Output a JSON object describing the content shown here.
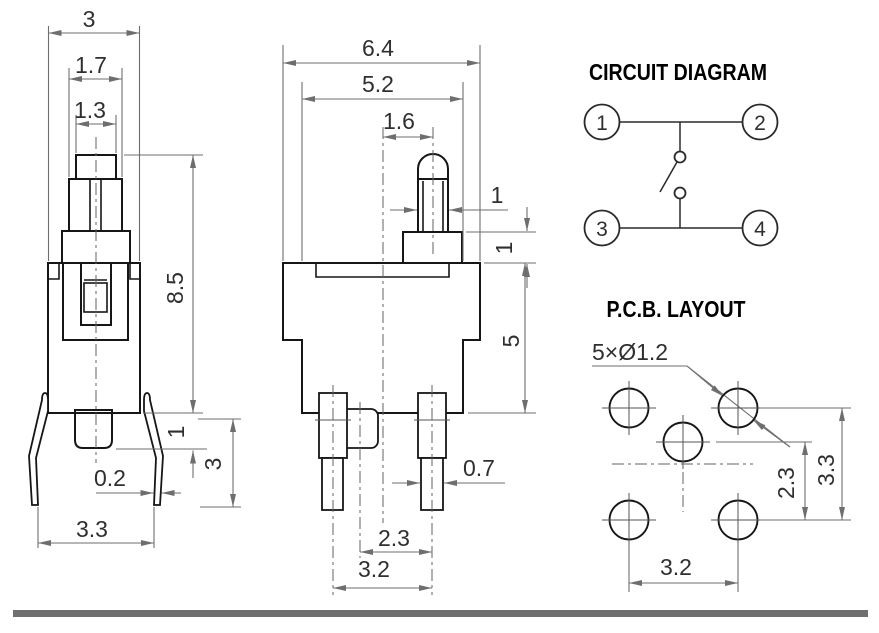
{
  "meta": {
    "outline_color": "#161616",
    "dim_color": "#6e6e6e",
    "centerline_color": "#636363",
    "text_color": "#2f2f2f",
    "title_color": "#000000",
    "bar_color": "#6f6f6f",
    "bg_color": "#ffffff"
  },
  "front_view": {
    "dims": {
      "overall_width": "3",
      "stem_width": "1.7",
      "cap_width": "1.3",
      "height": "8.5",
      "peg_protrusion": "1",
      "leg_length": "3",
      "leg_thickness": "0.2",
      "leg_span": "3.3"
    }
  },
  "side_view": {
    "dims": {
      "overall_width": "6.4",
      "upper_body_width": "5.2",
      "stem_offset": "1.6",
      "stem_width": "1",
      "boss_height": "1",
      "body_height": "5",
      "pin_width": "0.7",
      "peg_to_pin_pitch": "2.3",
      "pin_pitch": "3.2"
    }
  },
  "circuit_diagram": {
    "title": "CIRCUIT DIAGRAM",
    "terminals": [
      "1",
      "2",
      "3",
      "4"
    ]
  },
  "pcb_layout": {
    "title": "P.C.B. LAYOUT",
    "hole_callout": "5×Ø1.2",
    "dims": {
      "row_pitch": "3.3",
      "center_hole_offset": "2.3",
      "column_pitch": "3.2"
    }
  }
}
